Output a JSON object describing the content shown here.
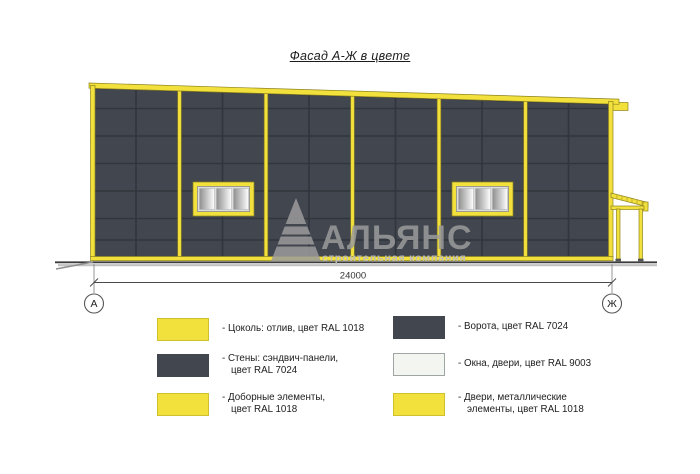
{
  "title": "Фасад А-Ж в цвете",
  "colors": {
    "yellow": "#f2e13c",
    "yellow_dark": "#8f831f",
    "wall": "#42464f",
    "joint": "#31353c",
    "window_ral9003": "#f2f5f0",
    "watermark": "#9b9b9b"
  },
  "drawing": {
    "dimension_label": "24000",
    "axis_left": "А",
    "axis_right": "Ж",
    "watermark": {
      "name": "АЛЬЯНС",
      "subtitle": "строительная компания"
    }
  },
  "legend": {
    "left": [
      {
        "swatch": "yellow",
        "label": "- Цоколь: отлив, цвет RAL 1018"
      },
      {
        "swatch": "dark",
        "label": "- Стены: сэндвич-панели,\nцвет RAL 7024"
      },
      {
        "swatch": "yellow",
        "label": "- Доборные элементы,\nцвет RAL 1018"
      }
    ],
    "right": [
      {
        "swatch": "dark",
        "label": "- Ворота, цвет RAL 7024"
      },
      {
        "swatch": "light",
        "label": "- Окна, двери, цвет RAL 9003"
      },
      {
        "swatch": "yellow",
        "label": "- Двери, металлические\nэлементы, цвет RAL 1018"
      }
    ]
  }
}
